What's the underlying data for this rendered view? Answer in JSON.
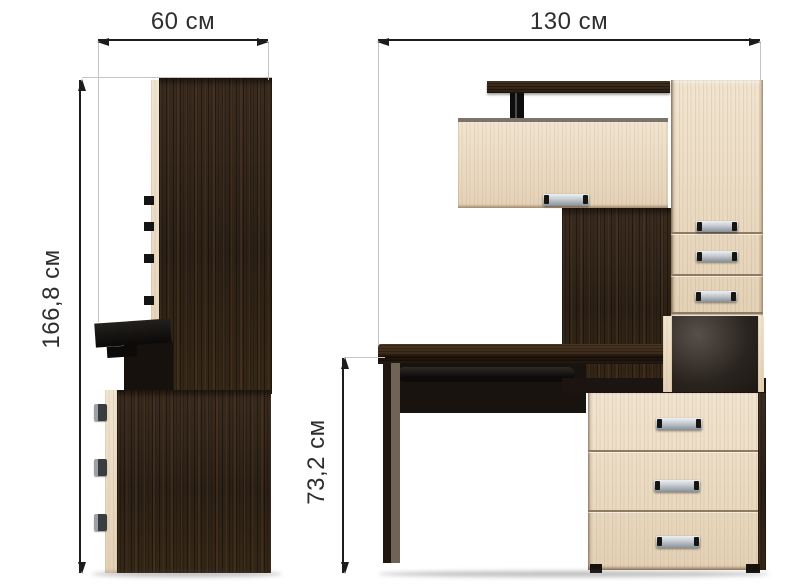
{
  "views": {
    "side": {
      "width_label": "60 см",
      "height_label": "166,8 см"
    },
    "front": {
      "width_label": "130 см",
      "desk_height_label": "73,2 см"
    }
  },
  "colors": {
    "background": "#ffffff",
    "dark_wood_wenge": "#30231a",
    "light_wood_maple": "#ead9c2",
    "handle_silver": "#c3c9cf",
    "dimension_line": "#1c1c1c",
    "extension_line": "#c4c4c4",
    "label_text": "#2e2e2e"
  }
}
